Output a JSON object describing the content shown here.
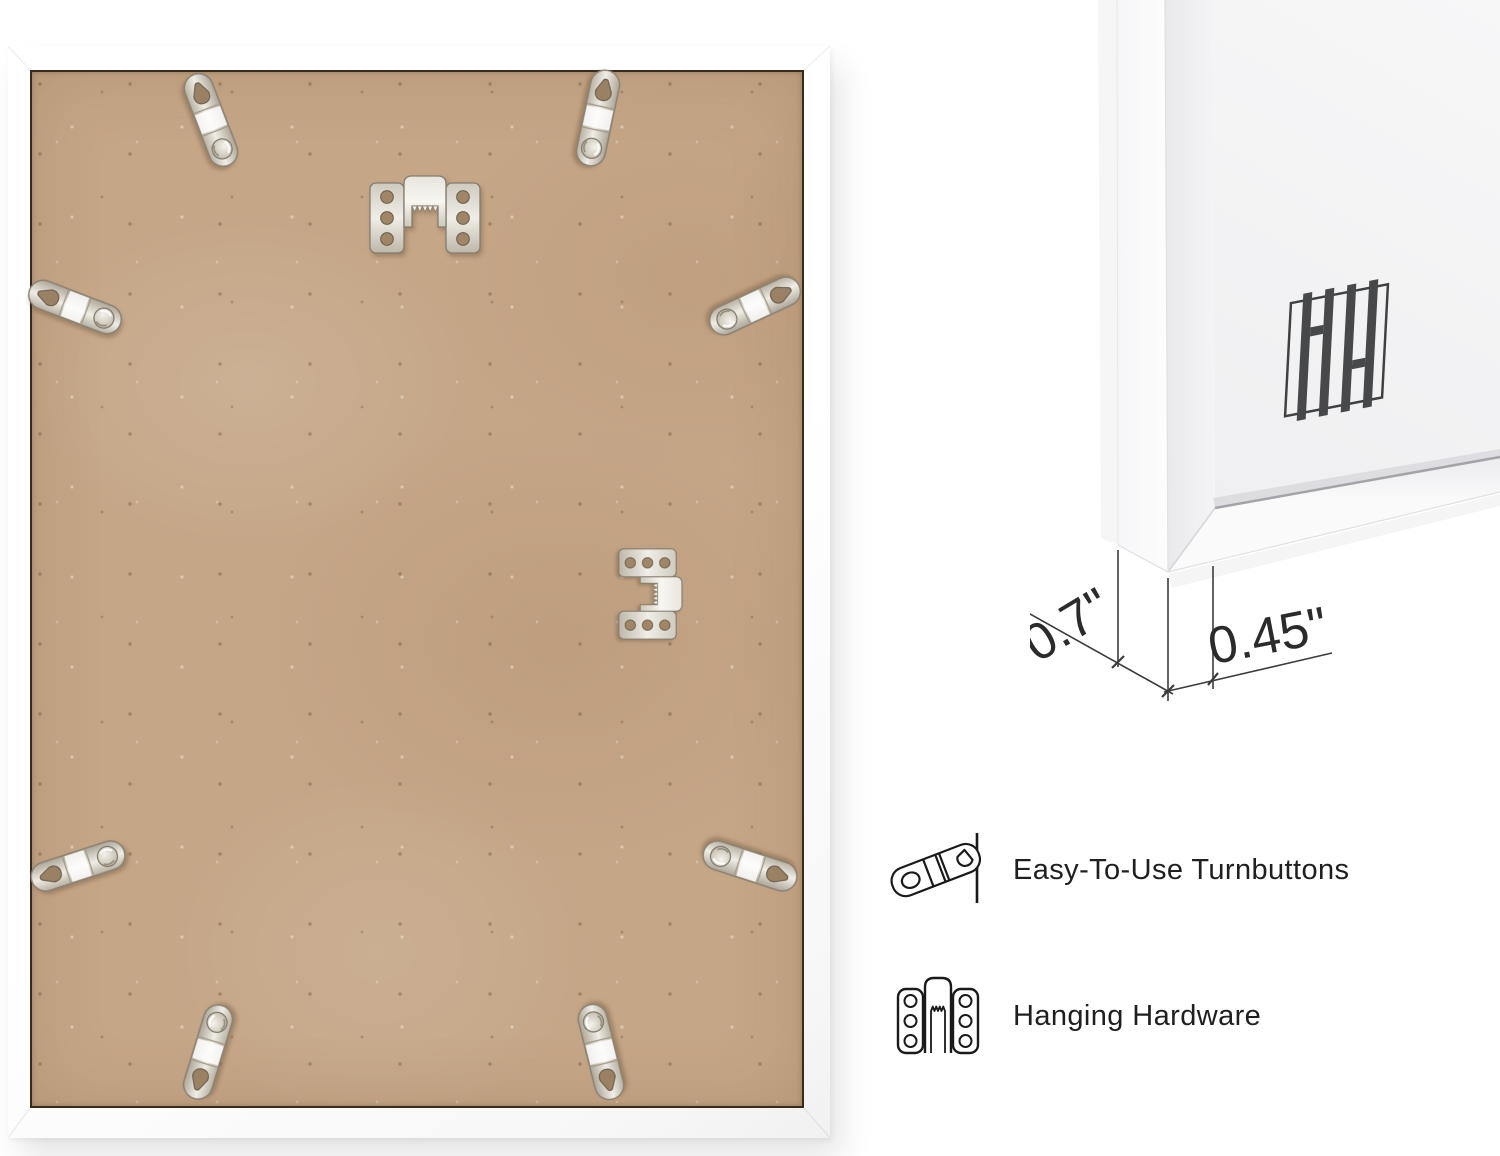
{
  "page": {
    "background": "#ffffff"
  },
  "back_photo": {
    "frame_color": "#ffffff",
    "backing_color": "#c5a687",
    "turnbutton_count": 8,
    "sawtooth_hanger_count": 2
  },
  "closeup": {
    "logo": "HH monogram",
    "measurements": {
      "depth": "0.7\"",
      "face_width": "0.45\""
    }
  },
  "features": [
    {
      "icon": "turnbutton-icon",
      "label": "Easy-To-Use Turnbuttons"
    },
    {
      "icon": "hanging-hardware-icon",
      "label": "Hanging Hardware"
    }
  ],
  "colors": {
    "logo_mark": "#47484a",
    "label_text": "#1f1f1f",
    "dimension_text": "#2b2b2b"
  }
}
